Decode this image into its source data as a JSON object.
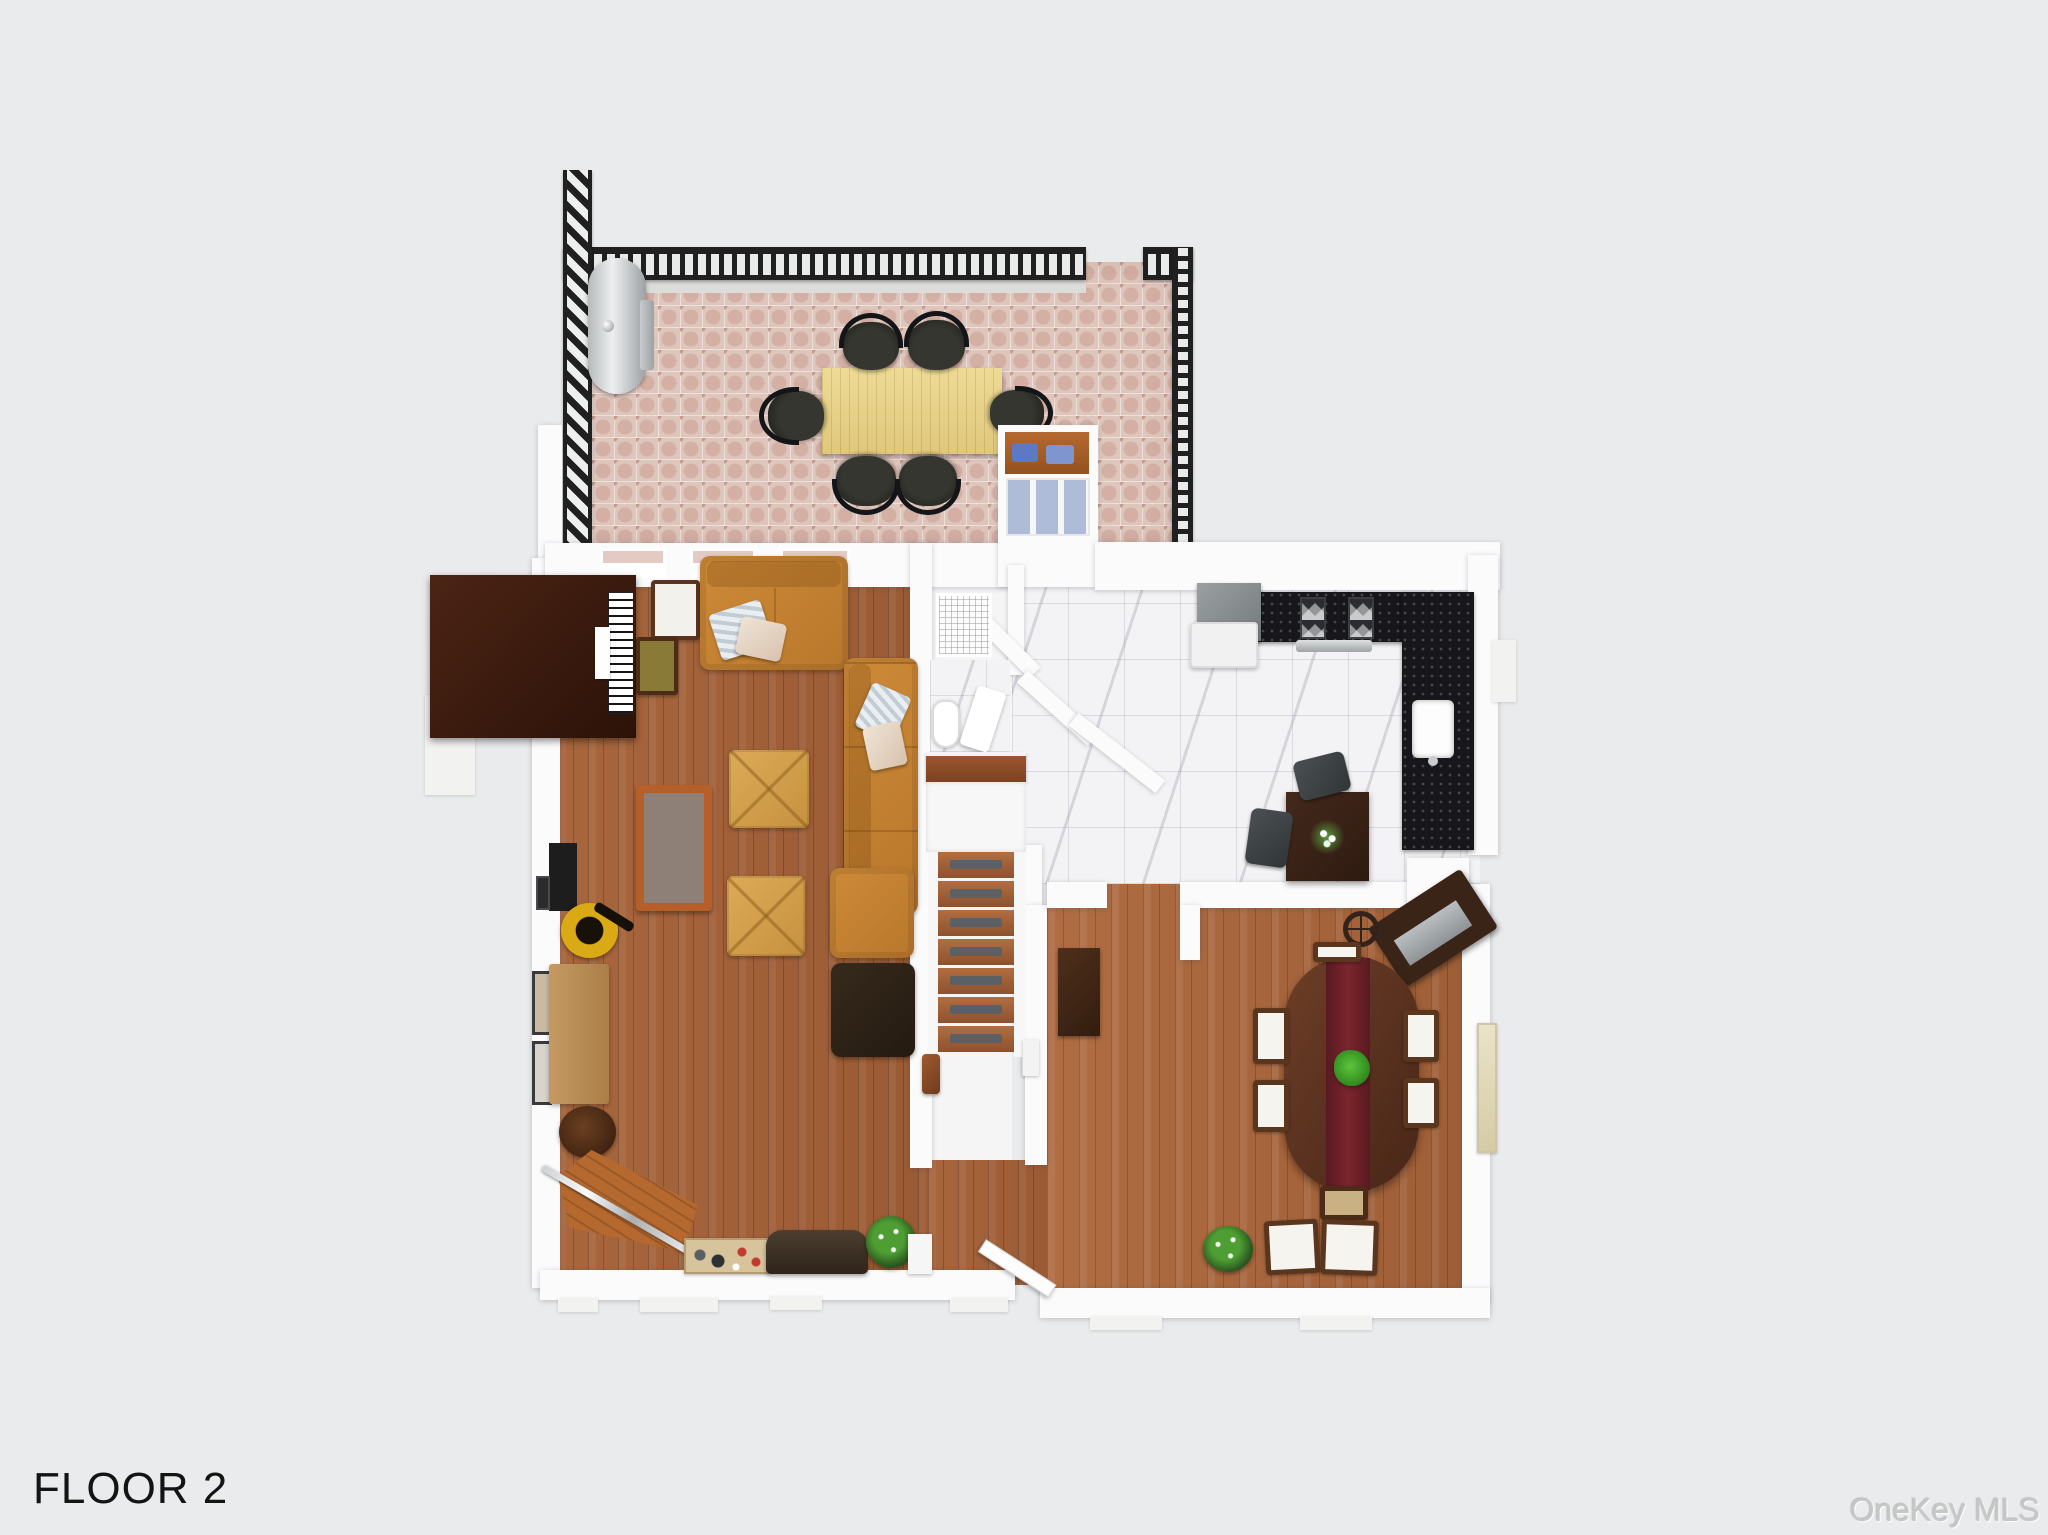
{
  "labels": {
    "floor_label": "FLOOR 2",
    "watermark": "OneKey MLS"
  },
  "palette": {
    "background": "#e9ebec",
    "wall_white": "#fbfbfc",
    "deck_paver_pink": "#dfc6bc",
    "railing_black": "#202020",
    "wood_floor": "#a3613a",
    "marble_floor": "#f3f3f5",
    "counter_black": "#16161b",
    "sofa_orange": "#c8842f",
    "ottoman_tan": "#d2a04c",
    "deck_table_wood": "#e8d28d",
    "dining_table_wood": "#5a3120",
    "runner_red": "#6d1f27",
    "plant_green": "#3f9c2a",
    "cushion_blue": "#5b79c4",
    "text_black": "#141414",
    "watermark_gray": "#c6c8c8"
  }
}
